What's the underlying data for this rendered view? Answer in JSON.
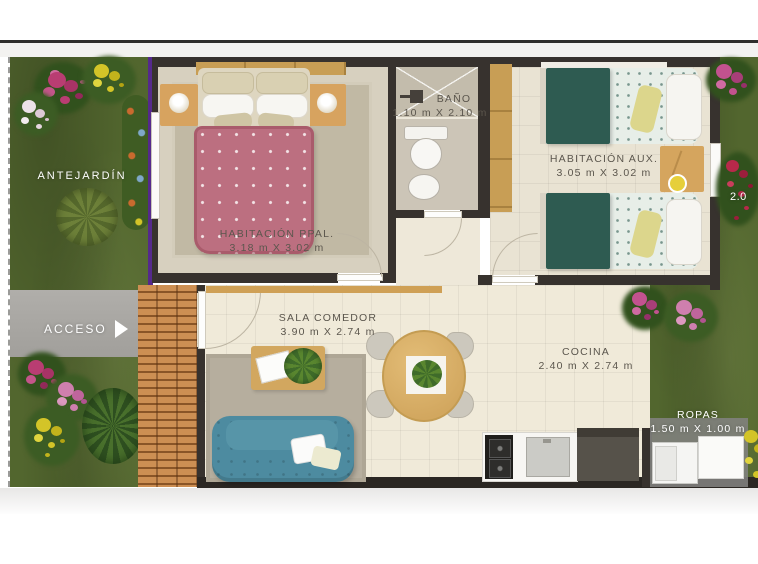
{
  "meta": {
    "drawing_type": "apartment floor plan, top view render"
  },
  "colors": {
    "wall": "#37322e",
    "grass": "#52662e",
    "walkway_gray": "#a8a6a2",
    "tile_path": "#c8874b",
    "lot_boundary_purple": "#55298c",
    "bed_main_pink": "#bc6f80",
    "bed_aux_teal": "#2e5b51",
    "sofa_teal": "#4d8ba0",
    "floor_cream": "#f0ead9",
    "carpet_tan": "#c1b9a4",
    "label_text": "#5b564d"
  },
  "garden": {
    "antejardin_label": "ANTEJARDÍN",
    "acceso_label": "ACCESO",
    "edge_dimension": "2.0"
  },
  "rooms": {
    "habitacion_ppal": {
      "name": "HABITACIÓN PPAL.",
      "dimensions": "3.18 m X 3.02 m"
    },
    "bano": {
      "name": "BAÑO",
      "dimensions": "1.10 m X 2.10 m"
    },
    "habitacion_aux": {
      "name": "HABITACIÓN AUX.",
      "dimensions": "3.05 m X 3.02 m"
    },
    "sala_comedor": {
      "name": "SALA COMEDOR",
      "dimensions": "3.90 m X 2.74 m"
    },
    "cocina": {
      "name": "COCINA",
      "dimensions": "2.40 m X 2.74 m"
    },
    "ropas": {
      "name": "ROPAS",
      "dimensions": "1.50 m X 1.00 m"
    }
  }
}
